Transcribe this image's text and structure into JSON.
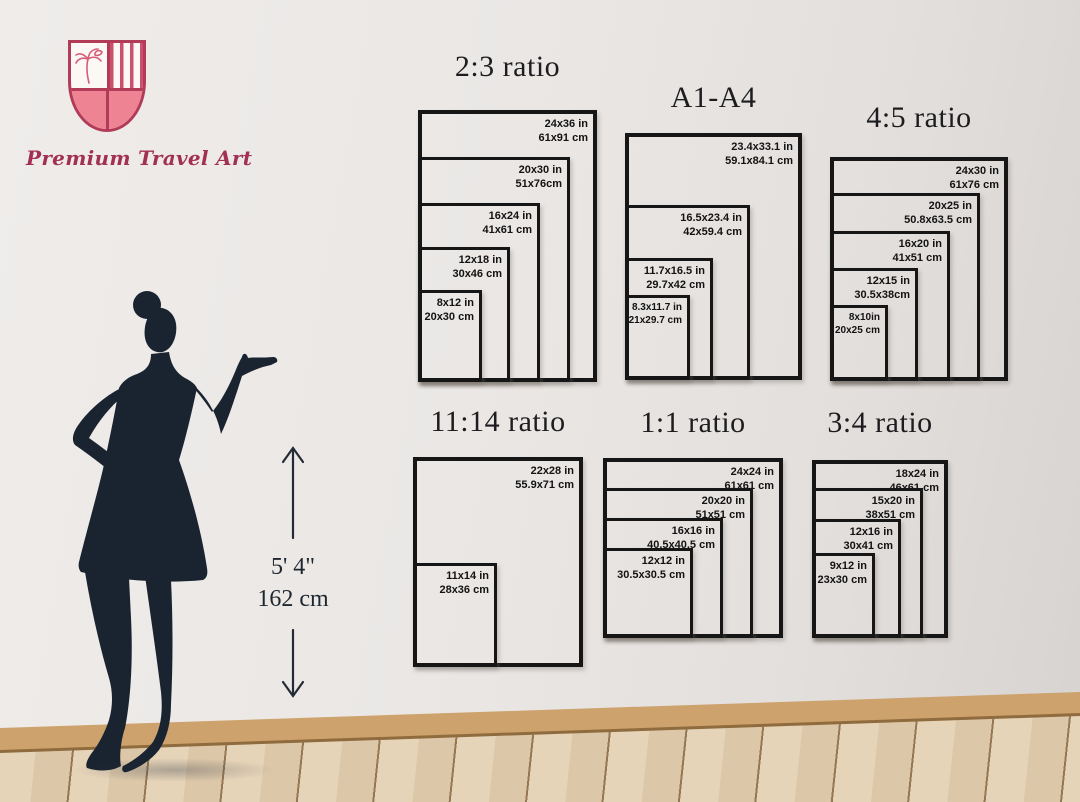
{
  "brand": {
    "name": "Premium Travel Art"
  },
  "height_reference": {
    "feet_inches": "5' 4\"",
    "centimeters": "162 cm"
  },
  "size_groups": [
    {
      "title": "2:3 ratio",
      "sizes": [
        {
          "inches": "24x36 in",
          "cm": "61x91 cm"
        },
        {
          "inches": "20x30 in",
          "cm": "51x76cm"
        },
        {
          "inches": "16x24 in",
          "cm": "41x61 cm"
        },
        {
          "inches": "12x18 in",
          "cm": "30x46 cm"
        },
        {
          "inches": "8x12 in",
          "cm": "20x30 cm"
        }
      ]
    },
    {
      "title": "A1-A4",
      "sizes": [
        {
          "inches": "23.4x33.1 in",
          "cm": "59.1x84.1 cm"
        },
        {
          "inches": "16.5x23.4 in",
          "cm": "42x59.4 cm"
        },
        {
          "inches": "11.7x16.5 in",
          "cm": "29.7x42 cm"
        },
        {
          "inches": "8.3x11.7 in",
          "cm": "21x29.7 cm"
        }
      ]
    },
    {
      "title": "4:5 ratio",
      "sizes": [
        {
          "inches": "24x30 in",
          "cm": "61x76 cm"
        },
        {
          "inches": "20x25 in",
          "cm": "50.8x63.5 cm"
        },
        {
          "inches": "16x20 in",
          "cm": "41x51 cm"
        },
        {
          "inches": "12x15 in",
          "cm": "30.5x38cm"
        },
        {
          "inches": "8x10in",
          "cm": "20x25 cm"
        }
      ]
    },
    {
      "title": "11:14 ratio",
      "sizes": [
        {
          "inches": "22x28 in",
          "cm": "55.9x71 cm"
        },
        {
          "inches": "11x14 in",
          "cm": "28x36 cm"
        }
      ]
    },
    {
      "title": "1:1 ratio",
      "sizes": [
        {
          "inches": "24x24 in",
          "cm": "61x61 cm"
        },
        {
          "inches": "20x20 in",
          "cm": "51x51 cm"
        },
        {
          "inches": "16x16 in",
          "cm": "40.5x40.5 cm"
        },
        {
          "inches": "12x12 in",
          "cm": "30.5x30.5 cm"
        }
      ]
    },
    {
      "title": "3:4 ratio",
      "sizes": [
        {
          "inches": "18x24 in",
          "cm": "46x61 cm"
        },
        {
          "inches": "15x20 in",
          "cm": "38x51 cm"
        },
        {
          "inches": "12x16 in",
          "cm": "30x41 cm"
        },
        {
          "inches": "9x12 in",
          "cm": "23x30 cm"
        }
      ]
    }
  ],
  "colors": {
    "accent_red": "#b23c58",
    "shield_fill": "#ee8394",
    "frame_line": "#161616",
    "silhouette": "#1a2430",
    "wall": "#e9e6e4",
    "floor_wood": "#dcc8a9",
    "baseboard": "#cda26c"
  }
}
